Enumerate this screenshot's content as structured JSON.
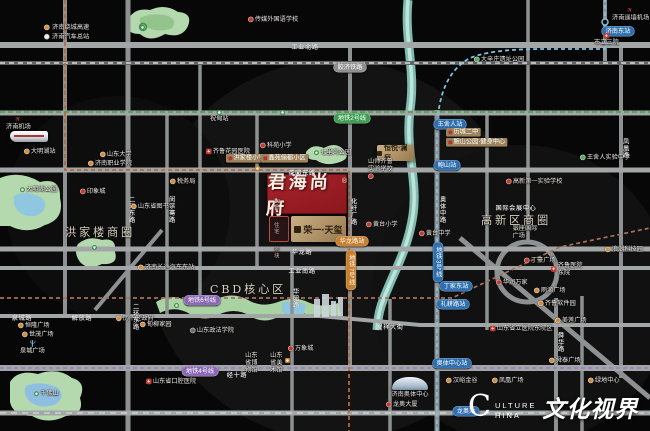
{
  "map": {
    "width": 650,
    "height": 431,
    "city": "济南"
  },
  "colors": {
    "background": "#070707",
    "road": "#a2a6a6",
    "park": "#b5d9ae",
    "water": "#8fc6e0",
    "project_red": "#9c2125",
    "gold": "#b99a6e",
    "metro_line2": "#4aa54a",
    "metro_line3": "#7fc0e0",
    "metro_line4": "#9a7fc0",
    "metro_line6": "#a8705a",
    "elevated_dashed": "#b5683a"
  },
  "legend": {
    "items": [
      {
        "icon": "orange-dot",
        "label": "济南绕城高速"
      },
      {
        "icon": "white-dot",
        "label": "济南汽车总站"
      }
    ]
  },
  "project": {
    "name": "君海尚府",
    "mark": "®"
  },
  "watermark": {
    "c1": "C",
    "c2": "ULTURE",
    "c3": "HINA",
    "cn": "文化视界"
  },
  "markers": [
    {
      "t": "plane",
      "x": 612,
      "y": 7,
      "side": "b",
      "label": "济南遥墙机场",
      "n": "airport-marker"
    },
    {
      "t": "pill",
      "c": "blue",
      "x": 618,
      "y": 26,
      "label": "济南东站",
      "n": "metro-station-pill"
    },
    {
      "t": "cross",
      "x": 594,
      "y": 33,
      "side": "b",
      "label": "市立三院",
      "n": "hospital-marker"
    },
    {
      "t": "dot",
      "c": "g",
      "x": 474,
      "y": 56,
      "label": "大辛庄遗址公园",
      "n": "poi-marker"
    },
    {
      "t": "pill",
      "c": "gray",
      "x": 350,
      "y": 62,
      "label": "胶济铁路",
      "n": "railway-pill"
    },
    {
      "t": "roadh",
      "x": 305,
      "y": 44,
      "label": "工业北路",
      "n": "road-label"
    },
    {
      "t": "dot",
      "c": "r",
      "x": 248,
      "y": 16,
      "label": "传媒外国语学校",
      "n": "school-marker"
    },
    {
      "t": "parkpin",
      "x": 140,
      "y": 25,
      "label": "",
      "n": "park-pin"
    },
    {
      "t": "plane",
      "x": 6,
      "y": 116,
      "side": "b",
      "label": "济南机场",
      "n": "airport-marker"
    },
    {
      "t": "train",
      "x": 10,
      "y": 131,
      "label": "",
      "n": "train-icon"
    },
    {
      "t": "dot",
      "c": "o",
      "x": 24,
      "y": 148,
      "label": "大明湖站",
      "n": "poi-marker"
    },
    {
      "t": "stationicon",
      "c": "green",
      "x": 280,
      "y": 110,
      "label": "",
      "n": "metro-station-icon"
    },
    {
      "t": "station",
      "c": "green",
      "x": 210,
      "y": 110,
      "label": "祝甸站",
      "n": "metro-station-marker"
    },
    {
      "t": "pill",
      "c": "green",
      "x": 352,
      "y": 113,
      "label": "地铁2号线",
      "n": "metro-line-pill"
    },
    {
      "t": "dot",
      "c": "o",
      "x": 100,
      "y": 151,
      "label": "山东大学",
      "n": "poi-marker"
    },
    {
      "t": "dot",
      "c": "o",
      "x": 88,
      "y": 160,
      "label": "济南职业学院",
      "n": "poi-marker"
    },
    {
      "t": "cross",
      "x": 206,
      "y": 148,
      "label": "齐鲁花园医院",
      "n": "hospital-marker"
    },
    {
      "t": "roadv",
      "x": 127,
      "y": 196,
      "label": "二环东路",
      "n": "road-label"
    },
    {
      "t": "roadv",
      "x": 167,
      "y": 196,
      "label": "闵子骞路",
      "n": "road-label"
    },
    {
      "t": "dot",
      "c": "o",
      "x": 170,
      "y": 178,
      "label": "税务局",
      "n": "poi-marker"
    },
    {
      "t": "photo",
      "ph": "sepia",
      "x": 60,
      "y": 176,
      "w": 40,
      "h": 9,
      "label": "",
      "n": "building-photo"
    },
    {
      "t": "dot",
      "c": "r",
      "x": 80,
      "y": 188,
      "label": "印象城",
      "n": "poi-marker"
    },
    {
      "t": "dot",
      "c": "o",
      "x": 131,
      "y": 203,
      "label": "山东省图书馆",
      "n": "poi-marker"
    },
    {
      "t": "parkpin",
      "x": 20,
      "y": 186,
      "label": "大明湖公园",
      "n": "park-pin"
    },
    {
      "t": "district",
      "x": 100,
      "y": 226,
      "label": "洪家楼商圈",
      "n": "district-label"
    },
    {
      "t": "tag",
      "x": 226,
      "y": 154,
      "label": "洪家楼小学",
      "n": "school-tag"
    },
    {
      "t": "tag",
      "x": 261,
      "y": 154,
      "label": "鑫苑俪都小区",
      "n": "residence-tag"
    },
    {
      "t": "dot",
      "c": "r",
      "x": 260,
      "y": 142,
      "label": "科苑小学",
      "n": "school-marker"
    },
    {
      "t": "stationicon",
      "c": "orange",
      "x": 255,
      "y": 166,
      "label": "",
      "n": "metro-station-icon"
    },
    {
      "t": "roadh",
      "x": 302,
      "y": 170,
      "label": "花园东路",
      "n": "road-label"
    },
    {
      "t": "parkpin",
      "x": 314,
      "y": 149,
      "label": "七里河公园",
      "n": "park-pin"
    },
    {
      "t": "dot",
      "c": "r",
      "x": 368,
      "y": 158,
      "side": "t",
      "label": "山师齐鲁|实验学校",
      "n": "school-marker"
    },
    {
      "t": "dot",
      "c": "r",
      "x": 366,
      "y": 221,
      "label": "黄台小学",
      "n": "school-marker"
    },
    {
      "t": "dot",
      "c": "r",
      "x": 419,
      "y": 230,
      "label": "黄台中学",
      "n": "school-marker"
    },
    {
      "t": "pill",
      "c": "orange",
      "x": 352,
      "y": 236,
      "label": "华龙路站",
      "n": "metro-station-pill"
    },
    {
      "t": "pill",
      "c": "orange",
      "v": 1,
      "x": 351,
      "y": 250,
      "label": "地铁7号线",
      "n": "metro-line-pill"
    },
    {
      "t": "roadv",
      "x": 349,
      "y": 198,
      "label": "化纤厂路",
      "n": "road-label"
    },
    {
      "t": "roadh",
      "x": 302,
      "y": 249,
      "label": "华龙路",
      "n": "road-label"
    },
    {
      "t": "roadh",
      "x": 302,
      "y": 268,
      "label": "工业南路",
      "n": "road-label"
    },
    {
      "t": "roadv",
      "x": 438,
      "y": 196,
      "label": "奥体中路",
      "n": "road-label"
    },
    {
      "t": "pill",
      "c": "blue",
      "x": 450,
      "y": 119,
      "label": "王舍人站",
      "n": "metro-station-pill"
    },
    {
      "t": "tag",
      "x": 446,
      "y": 128,
      "label": "历城二中",
      "n": "school-tag"
    },
    {
      "t": "tag",
      "x": 446,
      "y": 138,
      "label": "鲍山公园·健身中心",
      "n": "poi-tag"
    },
    {
      "t": "pill",
      "c": "blue",
      "x": 447,
      "y": 160,
      "label": "鲍山站",
      "n": "metro-station-pill"
    },
    {
      "t": "dot",
      "c": "g",
      "x": 580,
      "y": 154,
      "label": "王舍人实验中学",
      "n": "school-marker"
    },
    {
      "t": "roadv",
      "x": 621,
      "y": 138,
      "label": "凤凰路",
      "n": "road-label"
    },
    {
      "t": "dot",
      "c": "r",
      "x": 506,
      "y": 178,
      "label": "高新第一实验学校",
      "n": "school-marker"
    },
    {
      "t": "roadh",
      "x": 516,
      "y": 205,
      "label": "国际会展中心",
      "n": "poi-label"
    },
    {
      "t": "district",
      "x": 516,
      "y": 214,
      "label": "高新区商圈",
      "n": "district-label"
    },
    {
      "t": "photo",
      "ph": "blue",
      "x": 505,
      "y": 224,
      "w": 40,
      "h": 16,
      "label": "银座国际广场",
      "n": "building-photo"
    },
    {
      "t": "dot",
      "c": "o",
      "x": 605,
      "y": 246,
      "label": "浪潮科技园",
      "n": "poi-marker"
    },
    {
      "t": "dot",
      "c": "r",
      "x": 524,
      "y": 257,
      "label": "丁豪广场",
      "n": "poi-marker"
    },
    {
      "t": "cross",
      "x": 551,
      "y": 262,
      "label": "齐鲁医院|东院",
      "n": "hospital-marker"
    },
    {
      "t": "dot",
      "c": "r",
      "x": 496,
      "y": 279,
      "label": "华润万家",
      "n": "poi-marker"
    },
    {
      "t": "dot",
      "c": "o",
      "x": 534,
      "y": 287,
      "label": "雨滴广场",
      "n": "poi-marker"
    },
    {
      "t": "dot",
      "c": "o",
      "x": 538,
      "y": 300,
      "label": "齐鲁软件园",
      "n": "poi-marker"
    },
    {
      "t": "dot",
      "c": "o",
      "x": 555,
      "y": 317,
      "label": "美莲广场",
      "n": "poi-marker"
    },
    {
      "t": "cross",
      "x": 490,
      "y": 325,
      "label": "山东省立医院东院区",
      "n": "hospital-marker"
    },
    {
      "t": "dot",
      "c": "o",
      "x": 549,
      "y": 357,
      "label": "舜泰广场",
      "n": "poi-marker"
    },
    {
      "t": "roadv",
      "x": 556,
      "y": 332,
      "label": "舜华路",
      "n": "road-label"
    },
    {
      "t": "pill",
      "c": "blue",
      "v": 1,
      "x": 438,
      "y": 242,
      "label": "地铁3号线",
      "n": "metro-line-pill"
    },
    {
      "t": "pill",
      "c": "blue",
      "x": 456,
      "y": 281,
      "label": "丁家东站",
      "n": "metro-station-pill"
    },
    {
      "t": "pill",
      "c": "blue",
      "x": 453,
      "y": 299,
      "label": "礼耕路站",
      "n": "metro-station-pill"
    },
    {
      "t": "pill",
      "c": "blue",
      "x": 452,
      "y": 358,
      "label": "奥体中心站",
      "n": "metro-station-pill"
    },
    {
      "t": "district",
      "x": 248,
      "y": 283,
      "label": "CBD核心区",
      "n": "district-label"
    },
    {
      "t": "pill",
      "c": "purple",
      "x": 202,
      "y": 295,
      "label": "地铁6号线",
      "n": "metro-line-pill"
    },
    {
      "t": "parkpin",
      "x": 174,
      "y": 303,
      "label": "",
      "n": "park-pin"
    },
    {
      "t": "dot",
      "c": "d",
      "x": 190,
      "y": 327,
      "label": "山东政法学院",
      "n": "poi-marker"
    },
    {
      "t": "dot",
      "c": "r",
      "x": 288,
      "y": 345,
      "label": "万象城",
      "n": "poi-marker"
    },
    {
      "t": "photo",
      "ph": "sepia",
      "x": 241,
      "y": 351,
      "w": 22,
      "h": 10,
      "label": "山东省博物馆",
      "n": "building-photo"
    },
    {
      "t": "photo",
      "ph": "sepia",
      "x": 266,
      "y": 351,
      "w": 22,
      "h": 10,
      "label": "山东省美术馆",
      "n": "building-photo"
    },
    {
      "t": "stationicon",
      "c": "orange",
      "x": 285,
      "y": 358,
      "label": "",
      "n": "metro-station-icon"
    },
    {
      "t": "roadh",
      "x": 390,
      "y": 324,
      "label": "发祥大街",
      "n": "road-label"
    },
    {
      "t": "roadv",
      "x": 291,
      "y": 288,
      "label": "华阳路",
      "n": "road-label"
    },
    {
      "t": "pill",
      "c": "purple",
      "x": 200,
      "y": 366,
      "label": "地铁4号线",
      "n": "metro-line-pill"
    },
    {
      "t": "roadh",
      "x": 237,
      "y": 372,
      "label": "经十路",
      "n": "road-label"
    },
    {
      "t": "cross",
      "x": 146,
      "y": 378,
      "label": "山东省口腔医院",
      "n": "hospital-marker"
    },
    {
      "t": "dot",
      "c": "o",
      "x": 116,
      "y": 315,
      "label": "历下区政府",
      "n": "poi-marker"
    },
    {
      "t": "dot",
      "c": "o",
      "x": 140,
      "y": 321,
      "label": "甸柳家园",
      "n": "poi-marker"
    },
    {
      "t": "roadv",
      "x": 131,
      "y": 303,
      "label": "二环东路",
      "n": "road-label"
    },
    {
      "t": "roadh",
      "x": 22,
      "y": 315,
      "label": "泉城路",
      "n": "road-label"
    },
    {
      "t": "roadh",
      "x": 82,
      "y": 315,
      "label": "解放路",
      "n": "road-label"
    },
    {
      "t": "dot",
      "c": "o",
      "x": 18,
      "y": 322,
      "label": "恒隆广场",
      "n": "poi-marker"
    },
    {
      "t": "dot",
      "c": "o",
      "x": 22,
      "y": 331,
      "label": "世茂广场",
      "n": "poi-marker"
    },
    {
      "t": "spring",
      "x": 20,
      "y": 340,
      "side": "b",
      "label": "泉城广场",
      "n": "spring-plaza-icon"
    },
    {
      "t": "parkpin",
      "x": 34,
      "y": 390,
      "label": "千佛山",
      "n": "park-pin"
    },
    {
      "t": "dome",
      "x": 380,
      "y": 377,
      "label": "济南奥体中心",
      "n": "stadium-icon"
    },
    {
      "t": "dot",
      "c": "r",
      "x": 386,
      "y": 401,
      "label": "龙奥大厦",
      "n": "poi-marker"
    },
    {
      "t": "pill",
      "c": "blue",
      "x": 466,
      "y": 406,
      "label": "龙奥站",
      "n": "metro-station-pill"
    },
    {
      "t": "dot",
      "c": "o",
      "x": 446,
      "y": 377,
      "label": "汉峪金谷",
      "n": "poi-marker"
    },
    {
      "t": "dot",
      "c": "o",
      "x": 492,
      "y": 377,
      "label": "凤凰广场",
      "n": "poi-marker"
    },
    {
      "t": "dot",
      "c": "o",
      "x": 588,
      "y": 377,
      "label": "绿地中心",
      "n": "poi-marker"
    },
    {
      "t": "dot",
      "c": "o",
      "x": 138,
      "y": 264,
      "label": "济南长途汽车东站",
      "n": "poi-marker"
    },
    {
      "t": "parkpin",
      "x": 92,
      "y": 245,
      "label": "",
      "n": "park-pin"
    }
  ],
  "boxes": {
    "parcel": {
      "lines": [
        "13号",
        "住宅",
        "地块"
      ]
    },
    "tianxi": {
      "name": "荣一·天玺"
    },
    "lanting": {
      "name": "恒悦·澜庭"
    }
  }
}
